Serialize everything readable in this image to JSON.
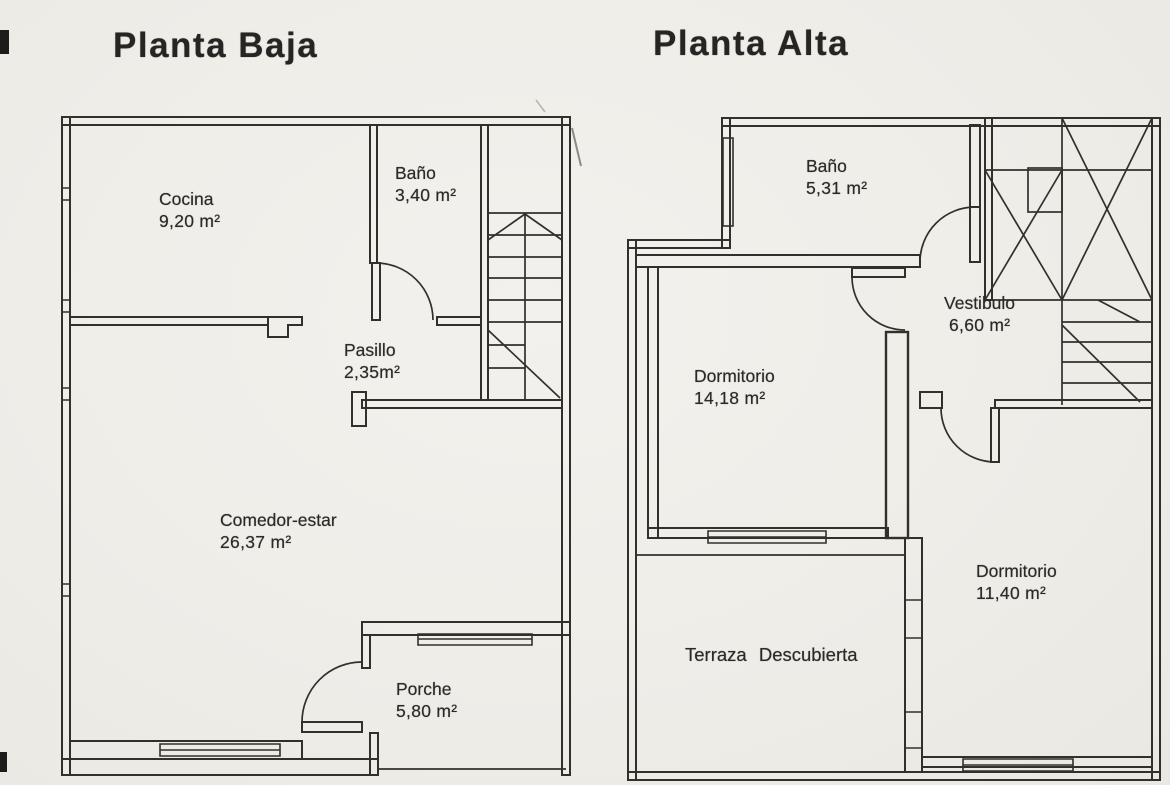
{
  "document_type": "floor-plan-scan",
  "colors": {
    "paper": "#f0eeea",
    "ink": "#33302c"
  },
  "plans": [
    {
      "title": "Planta Baja",
      "rooms": [
        {
          "name": "Cocina",
          "area": "9,20 m²"
        },
        {
          "name": "Baño",
          "area": "3,40 m²"
        },
        {
          "name": "Pasillo",
          "area": "2,35m²"
        },
        {
          "name": "Comedor-estar",
          "area": "26,37 m²"
        },
        {
          "name": "Porche",
          "area": "5,80 m²"
        }
      ]
    },
    {
      "title": "Planta Alta",
      "rooms": [
        {
          "name": "Baño",
          "area": "5,31 m²"
        },
        {
          "name": "Vestibulo",
          "area": "6,60 m²"
        },
        {
          "name": "Dormitorio",
          "area": "14,18 m²"
        },
        {
          "name": "Dormitorio",
          "area": "11,40 m²"
        },
        {
          "name": "Terraza Descubierta",
          "area": ""
        }
      ]
    }
  ]
}
